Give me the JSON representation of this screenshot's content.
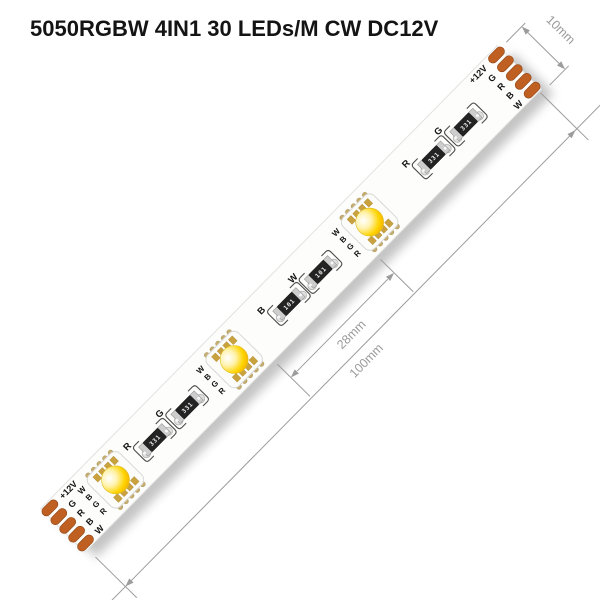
{
  "title": "5050RGBW 4IN1 30 LEDs/M CW DC12V",
  "strip": {
    "connector_pad_labels": [
      "+12V",
      "G",
      "R",
      "B",
      "W"
    ],
    "led_channel_labels": [
      "W",
      "B",
      "G",
      "R"
    ],
    "led_count": 3,
    "resistors": [
      {
        "label": "R",
        "value": "331"
      },
      {
        "label": "G",
        "value": "331"
      },
      {
        "label": "B",
        "value": "101"
      },
      {
        "label": "W",
        "value": "101"
      },
      {
        "label": "R",
        "value": "331"
      },
      {
        "label": "G",
        "value": "331"
      }
    ],
    "colors": {
      "pad_copper": "#bf5f22",
      "led_phosphor": "#ffd400",
      "strip_body": "#fdfdfc",
      "dimension_grey": "#9c9c9c"
    }
  },
  "dimensions": {
    "strip_width": "10mm",
    "led_spacing": "28mm",
    "section_length": "100mm"
  }
}
